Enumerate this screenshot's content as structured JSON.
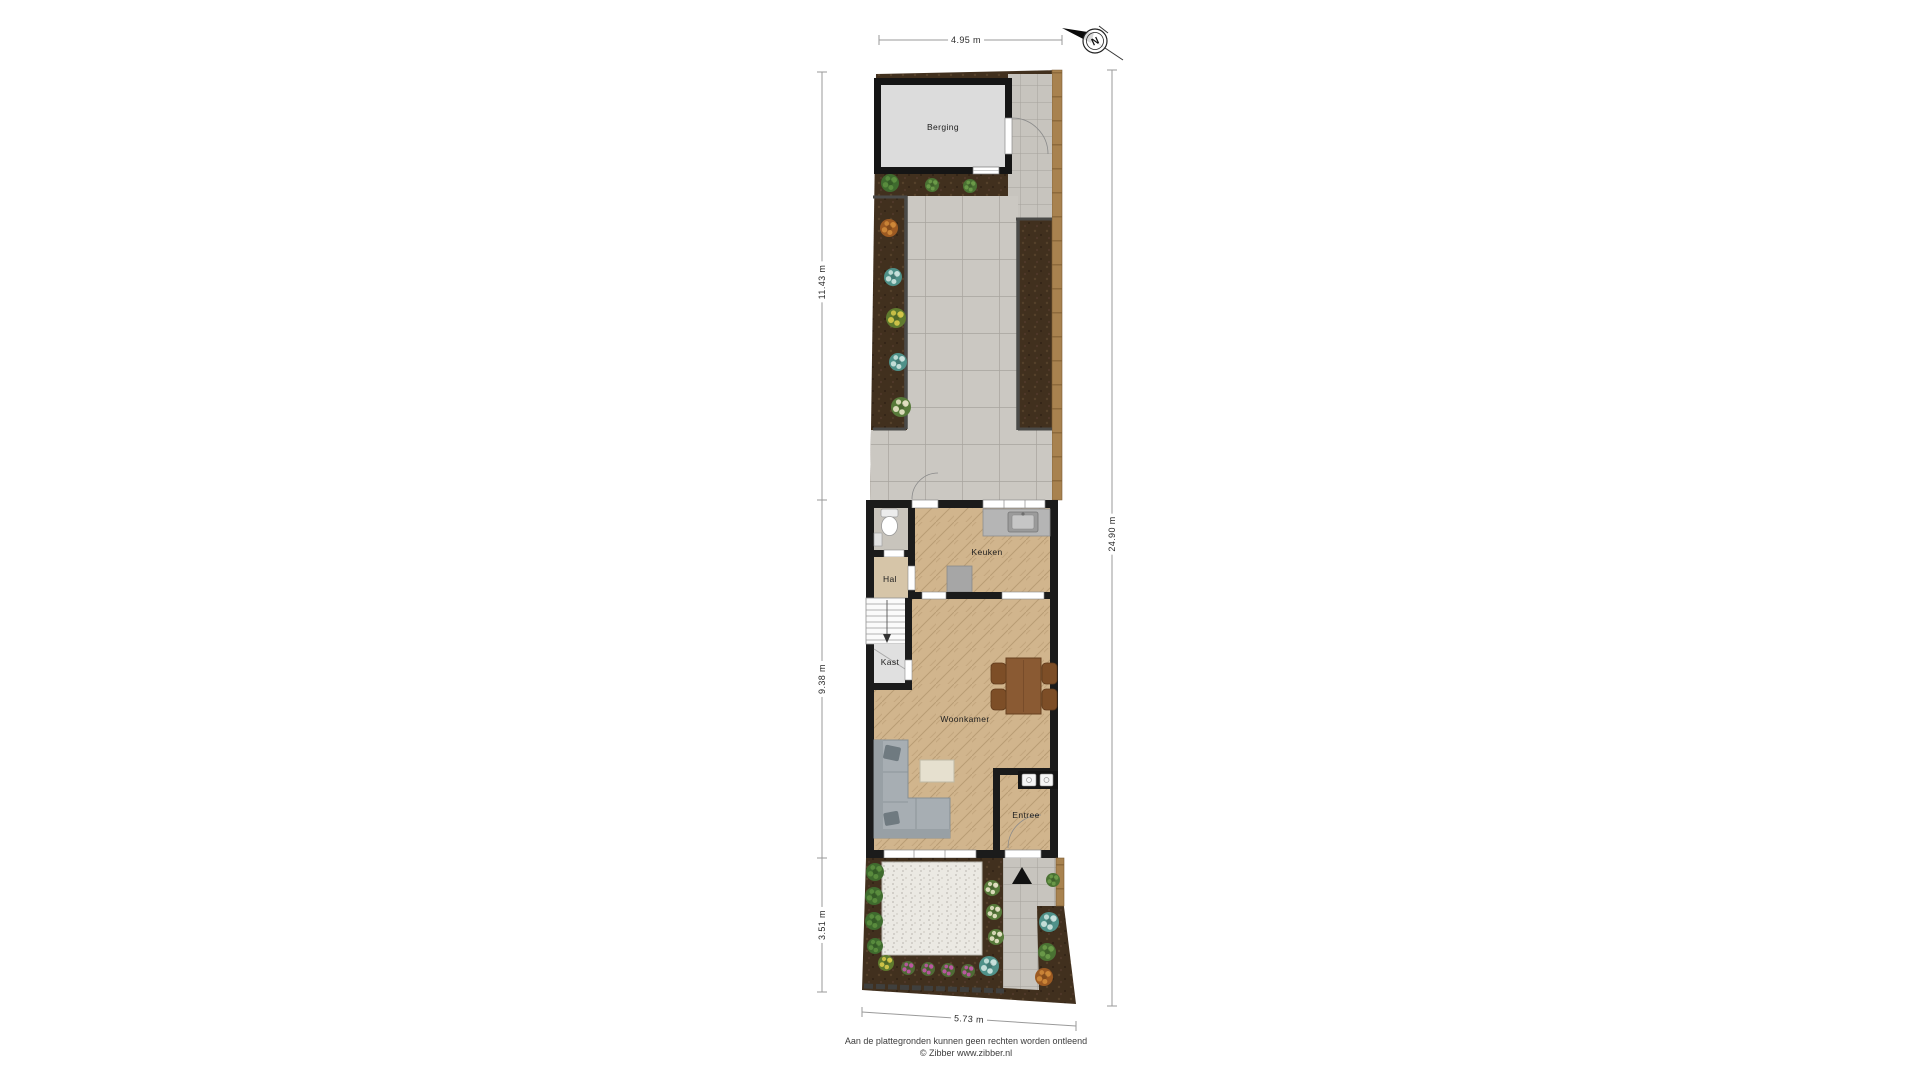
{
  "rooms": {
    "berging": "Berging",
    "keuken": "Keuken",
    "hal": "Hal",
    "kast": "Kast",
    "woonkamer": "Woonkamer",
    "entree": "Entree"
  },
  "dimensions": {
    "top_width": "4.95 m",
    "garden_depth": "11.43 m",
    "house_depth": "9.38 m",
    "front_garden_depth": "3.51 m",
    "total_depth": "24.90 m",
    "bottom_width": "5.73 m"
  },
  "compass": {
    "north_label": "N"
  },
  "footer": {
    "disclaimer": "Aan de plattegronden kunnen geen rechten worden ontleend",
    "copyright": "© Zibber www.zibber.nl"
  },
  "colors": {
    "wall": "#1b1b1b",
    "wood_floor": "#d1b58d",
    "paving": "#cbc8c2",
    "soil": "#41301e",
    "fence": "#a8824f",
    "gravel": "#ebe9e3",
    "sofa": "#a7aeb3",
    "table_wood": "#8a5a33",
    "shed_floor": "#dcdcdc"
  }
}
